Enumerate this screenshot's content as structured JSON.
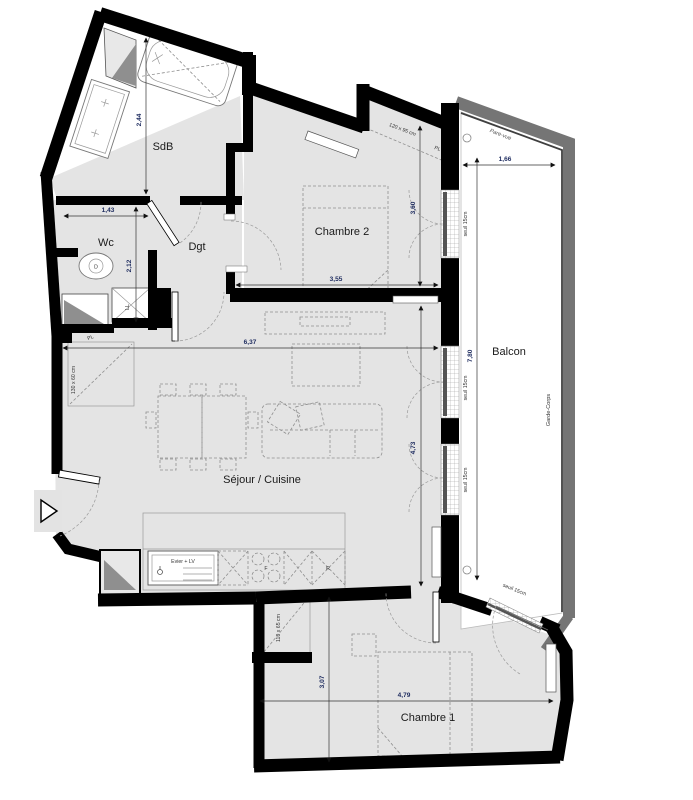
{
  "rooms": {
    "sdb": "SdB",
    "wc": "Wc",
    "dgt": "Dgt",
    "chambre2": "Chambre 2",
    "balcon": "Balcon",
    "sejour": "Séjour / Cuisine",
    "chambre1": "Chambre 1"
  },
  "dimensions": {
    "sdb_h": "2,44",
    "wc_w": "1,43",
    "wc_h": "2,12",
    "ch2_w": "3,55",
    "ch2_h": "3,60",
    "sejour_w": "6,37",
    "sejour_h": "4,73",
    "balcon_l": "7,80",
    "balcon_w": "1,66",
    "ch1_w": "4,79",
    "ch1_h": "3,07"
  },
  "annotations": {
    "pare_vue": "Pare-vue",
    "garde_corps": "Garde-Corps",
    "seuil": "seuil 15cm",
    "pl": "PL",
    "ll": "LL",
    "evier_lv": "Evier + LV",
    "four": "F",
    "refrigerateur": "R",
    "toilet_mark": "D",
    "pl_chambre2_size": "120 x 95 cm",
    "pl_sejour_size": "130 x 60 cm",
    "pl_chambre1_size": "110 x 65 cm"
  },
  "colors": {
    "wall": "#000000",
    "balcony_wall": "#757575",
    "floor": "#e4e4e4",
    "dim_text": "#1c2a5e"
  }
}
